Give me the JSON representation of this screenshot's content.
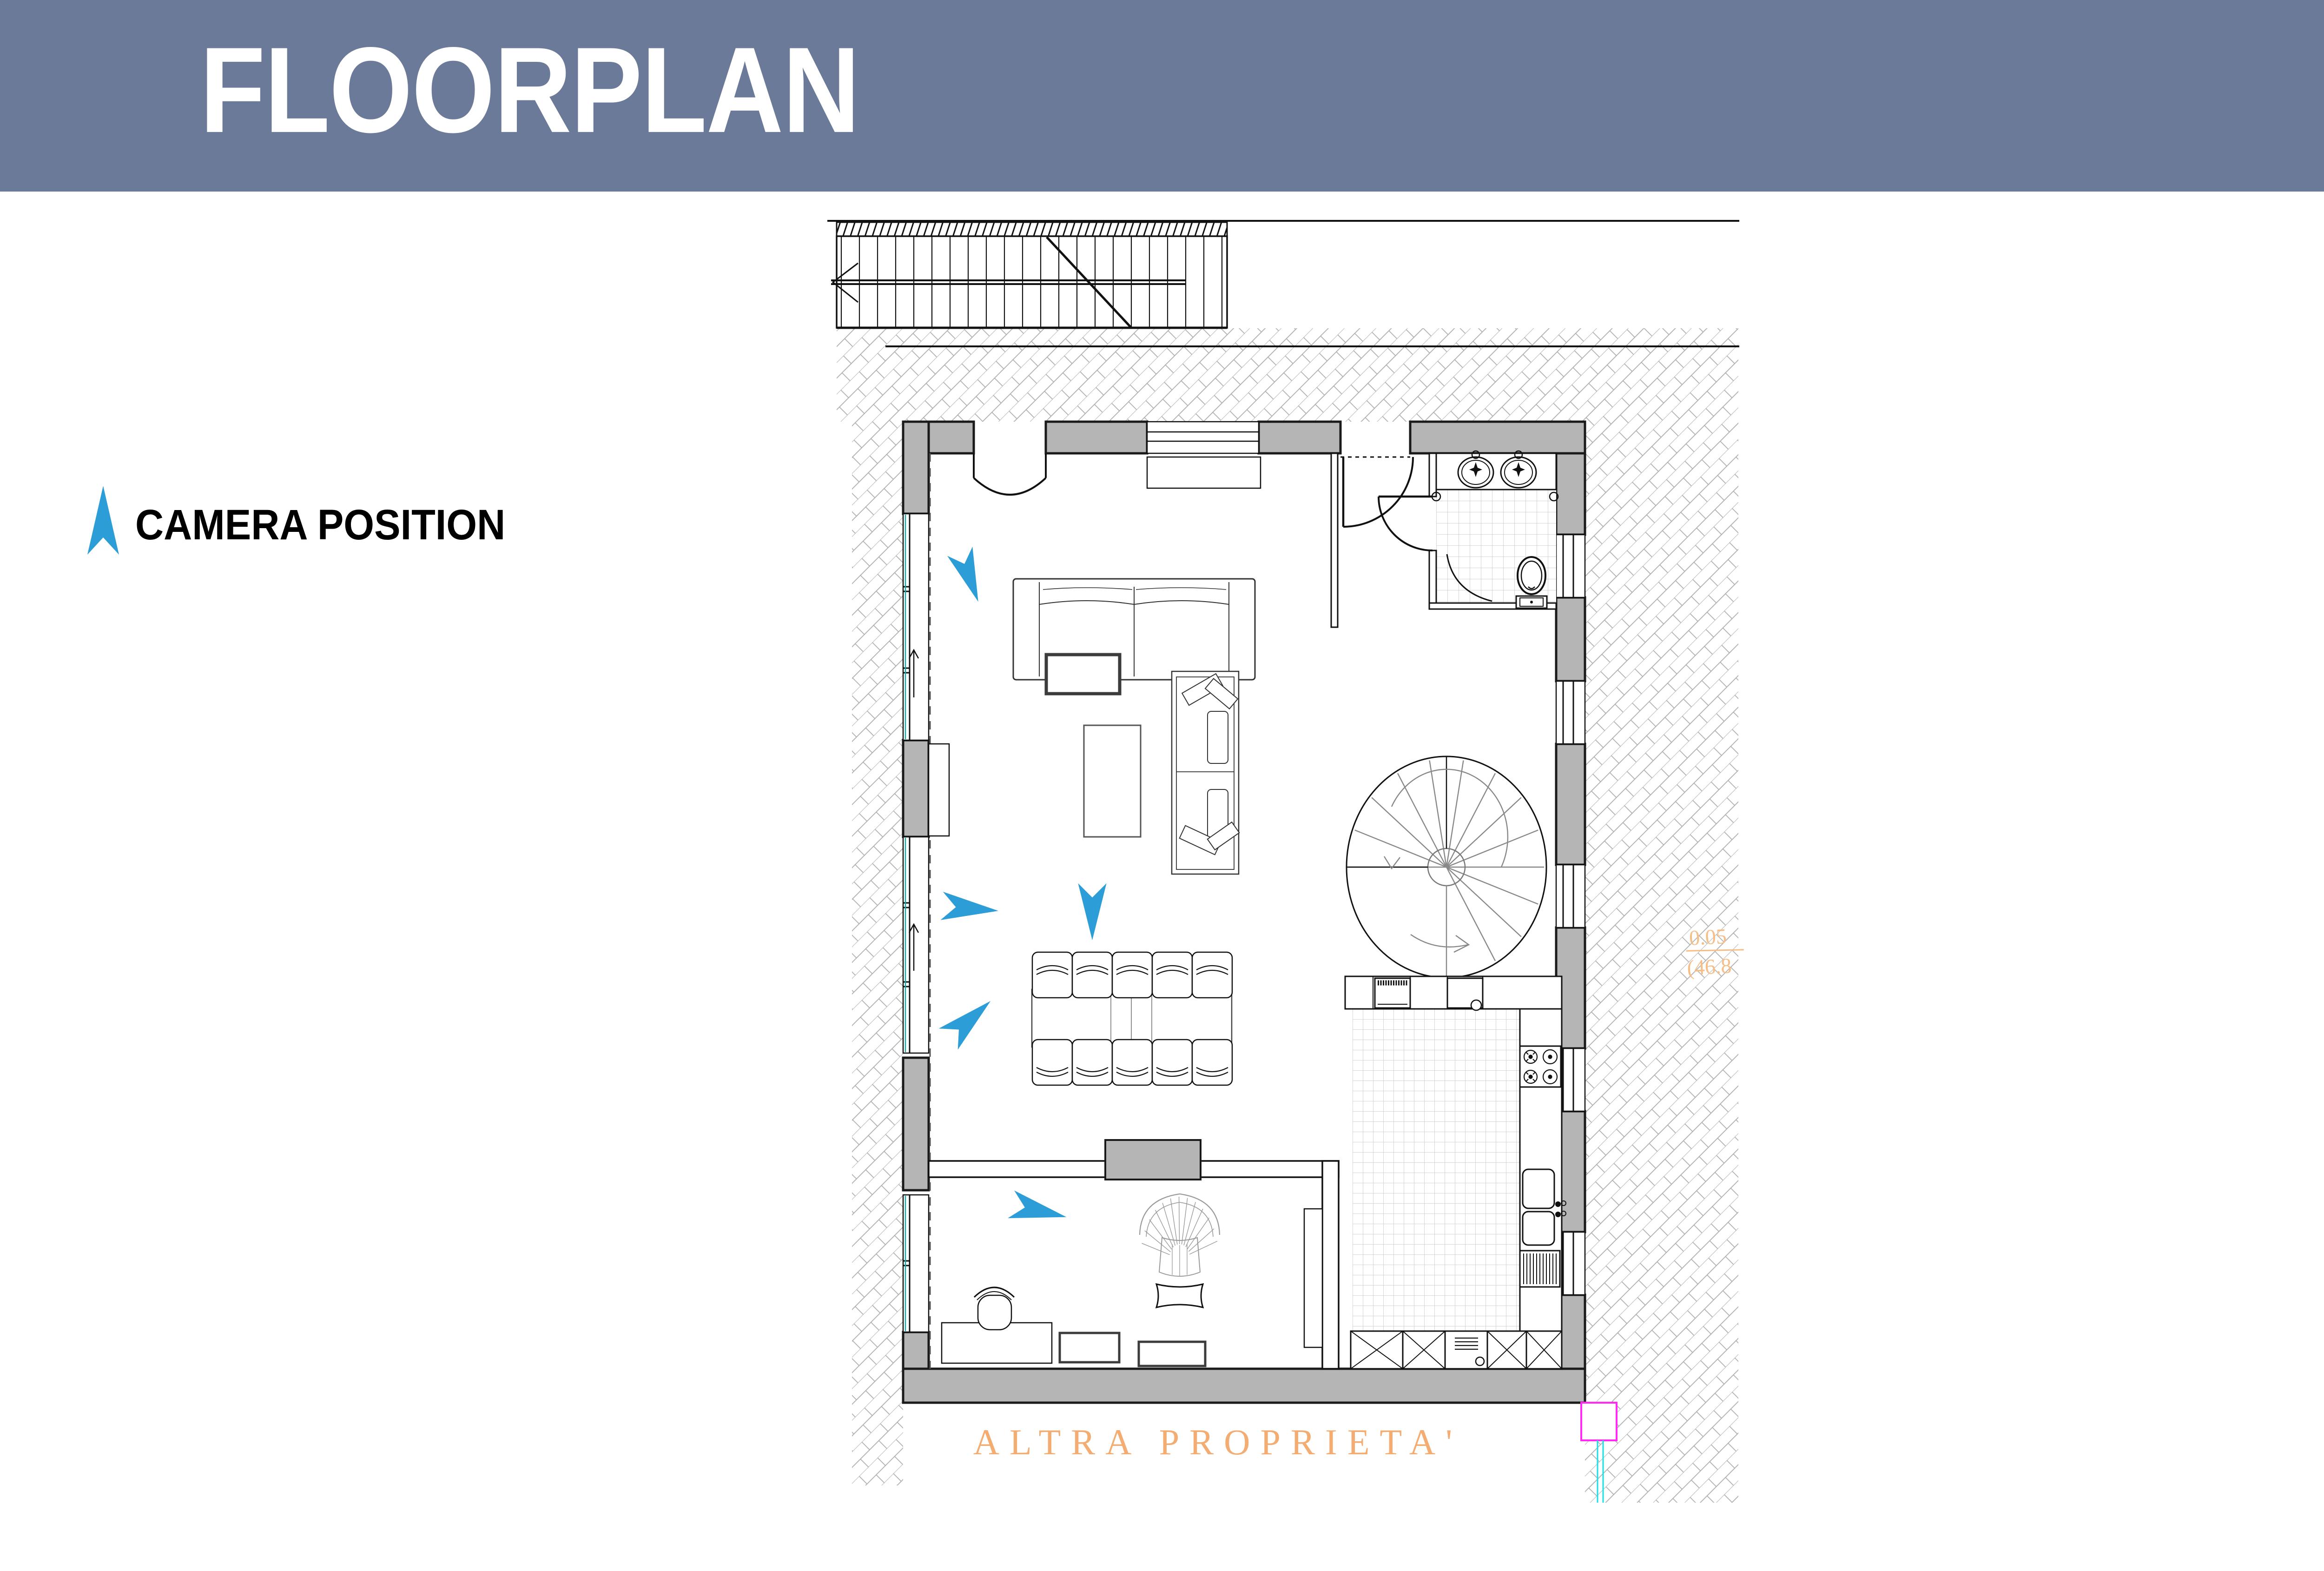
{
  "header": {
    "title": "FLOORPLAN"
  },
  "legend": {
    "label": "CAMERA POSITION",
    "arrow_icon": "camera-direction-arrow"
  },
  "plan": {
    "labels": {
      "other_property": "ALTRA  PROPRIETA'",
      "dimension_top": "0.05",
      "dimension_bottom": "(46.8"
    },
    "colors": {
      "header_bg": "#6B7A99",
      "camera_arrow_blue": "#2C9DD7",
      "wall_gray": "#B5B5B5",
      "annotation_orange": "#F3AC72",
      "dimension_orange": "#F5BE87",
      "survey_magenta": "#FF2BF0",
      "survey_cyan": "#18E2E2",
      "window_glass_teal": "#19A7A7",
      "tile_line_gray": "#CBCBCB"
    },
    "camera_arrows": {
      "count": 5,
      "directions": [
        "south-east",
        "east",
        "north-east",
        "south",
        "east-south-east"
      ]
    },
    "inventory": {
      "straight_staircase": 1,
      "spiral_staircase": 1,
      "sofas": 2,
      "coffee_table": 1,
      "side_table": 1,
      "dining_table": 1,
      "dining_chairs": 10,
      "bathroom": {
        "sinks": 2,
        "toilet": 1,
        "shower": 1
      },
      "kitchen": {
        "oven": 1,
        "hob_burners": 4,
        "sink_bowls": 2,
        "dishwasher": 1,
        "base_cabinets": 4
      },
      "office": {
        "desk": 1,
        "desk_chair": 1,
        "armchair": 1,
        "pouf": 1,
        "sideboards": 2,
        "cabinet": 1
      }
    }
  }
}
